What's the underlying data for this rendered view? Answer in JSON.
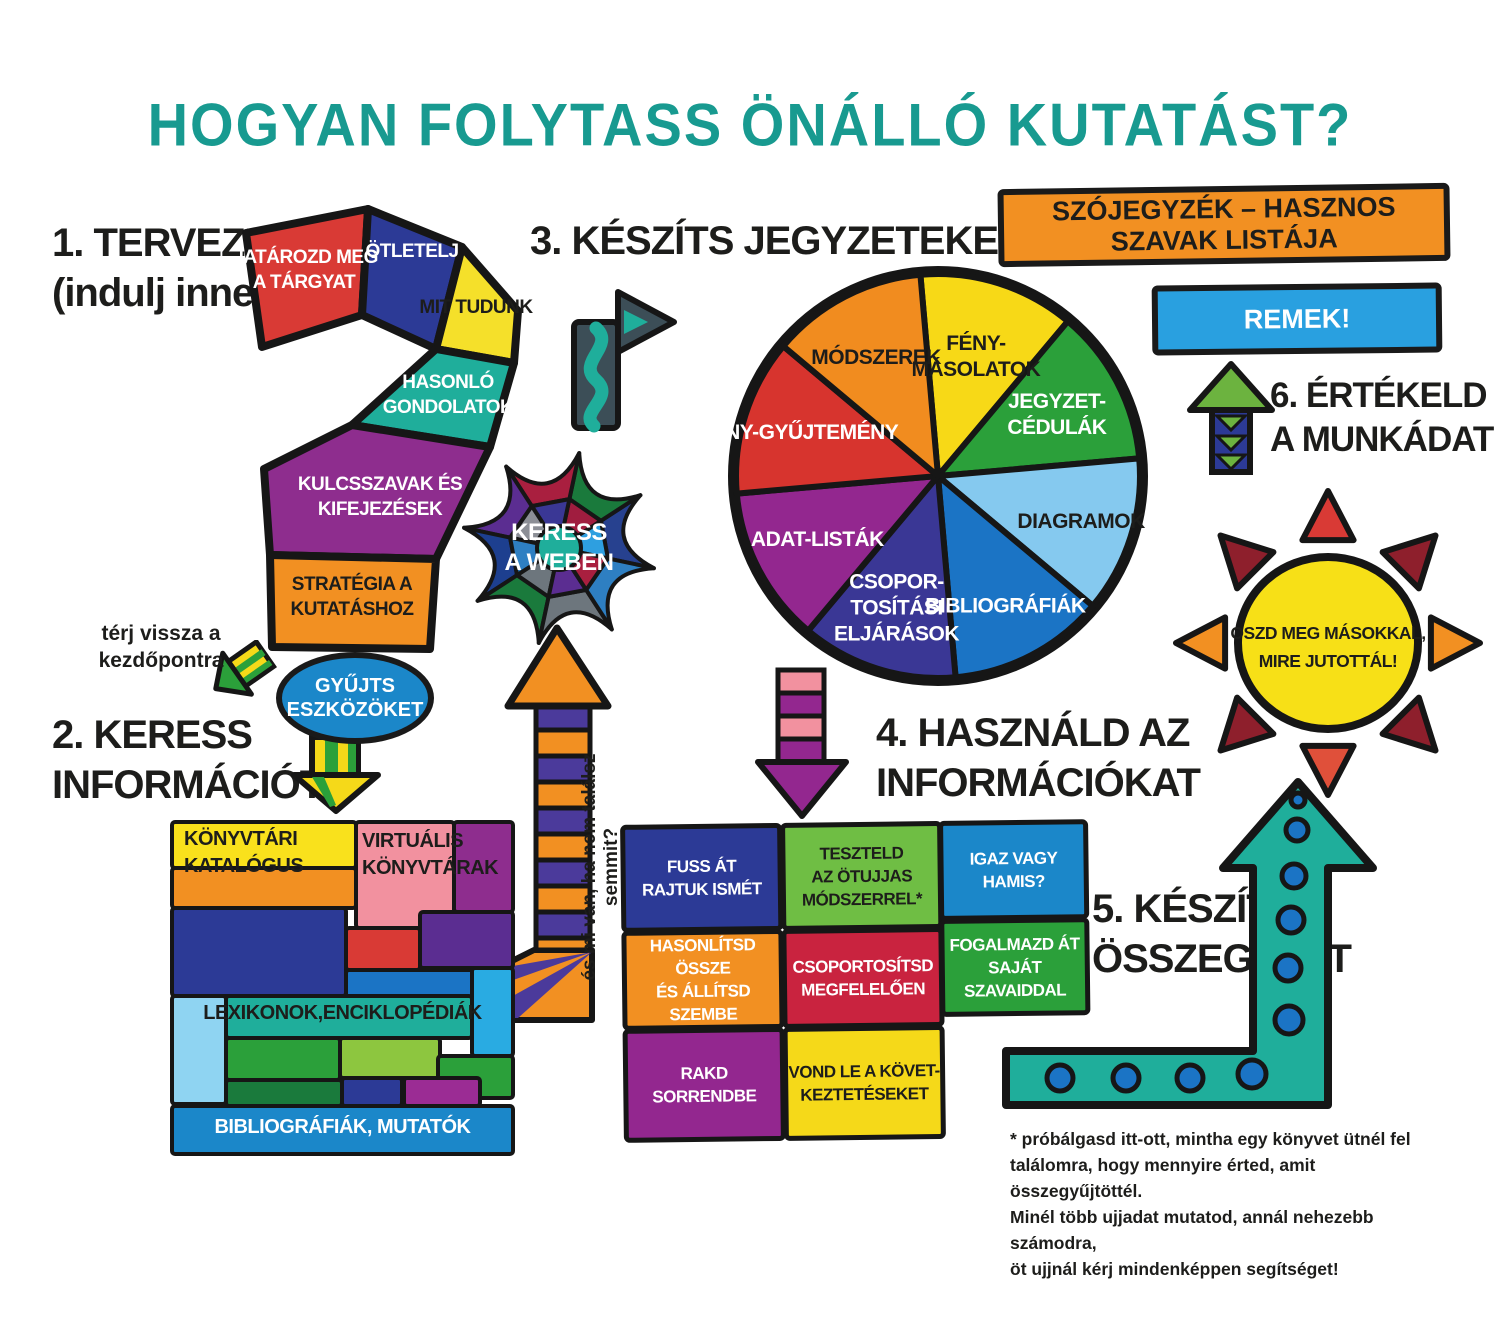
{
  "title": {
    "text": "HOGYAN FOLYTASS ÖNÁLLÓ KUTATÁST?",
    "color": "#189a90"
  },
  "steps": {
    "s1": [
      "1. TERVEZZ",
      "(indulj innen)"
    ],
    "s2": [
      "2. KERESS",
      "INFORMÁCIÓT"
    ],
    "s3": [
      "3. KÉSZÍTS JEGYZETEKET"
    ],
    "s4": [
      "4. HASZNÁLD AZ",
      "INFORMÁCIÓKAT"
    ],
    "s5": [
      "5. KÉSZÍTS",
      "ÖSSZEGZÉST"
    ],
    "s6": [
      "6. ÉRTÉKELD",
      "A MUNKÁDAT"
    ]
  },
  "question_mark": {
    "segments": [
      {
        "label": [
          "HATÁROZD MEG",
          "A TÁRGYAT"
        ],
        "color": "#d93a35",
        "text_color": "#ffffff"
      },
      {
        "label": [
          "ÖTLETELJ"
        ],
        "color": "#2c3a96",
        "text_color": "#ffffff"
      },
      {
        "label": [
          "MIT TUDUNK"
        ],
        "color": "#f5e02a",
        "text_color": "#1d1d1b"
      },
      {
        "label": [
          "HASONLÓ",
          "GONDOLATOK"
        ],
        "color": "#1fae9b",
        "text_color": "#ffffff"
      },
      {
        "label": [
          "KULCSSZAVAK ÉS",
          "KIFEJEZÉSEK"
        ],
        "color": "#8e2d8e",
        "text_color": "#ffffff"
      },
      {
        "label": [
          "STRATÉGIA A",
          "KUTATÁSHOZ"
        ],
        "color": "#f29022",
        "text_color": "#1d1d1b"
      }
    ]
  },
  "pie": {
    "slices": [
      {
        "label": [
          "FÉNY-",
          "MÁSOLATOK"
        ],
        "color": "#f7d917",
        "text_color": "#1d1d1b"
      },
      {
        "label": [
          "JEGYZET-",
          "CÉDULÁK"
        ],
        "color": "#2ba03a",
        "text_color": "#ffffff"
      },
      {
        "label": [
          "DIAGRAMOK"
        ],
        "color": "#85c9ef",
        "text_color": "#1d1d1b"
      },
      {
        "label": [
          "BIBLIOGRÁFIÁK"
        ],
        "color": "#1b74c5",
        "text_color": "#ffffff"
      },
      {
        "label": [
          "CSOPOR-",
          "TOSÍTÁSI",
          "ELJÁRÁSOK"
        ],
        "color": "#3a3795",
        "text_color": "#ffffff"
      },
      {
        "label": [
          "ADAT-LISTÁK"
        ],
        "color": "#93278f",
        "text_color": "#ffffff"
      },
      {
        "label": [
          "TÉNY-GYŰJTEMÉNY"
        ],
        "color": "#d7342e",
        "text_color": "#ffffff"
      },
      {
        "label": [
          "MÓDSZEREK"
        ],
        "color": "#f18c1f",
        "text_color": "#1d1d1b"
      }
    ]
  },
  "web": {
    "label": [
      "KERESS",
      "A WEBEN"
    ],
    "text_color": "#ffffff",
    "core_color": "#1fae9b",
    "outer_colors": [
      "#27418f",
      "#1a7a3c",
      "#a91f3f",
      "#5b2d91",
      "#1d3f8f",
      "#1a7a3c",
      "#6d767d",
      "#2e7fc2"
    ],
    "inner_colors": [
      "#2e9fe0",
      "#a01d3f",
      "#3a3795",
      "#8c8f96",
      "#2e7fc2",
      "#6d767d",
      "#5b2d91",
      "#a91f3f"
    ]
  },
  "banners": {
    "glossary": {
      "text": "SZÓJEGYZÉK – HASZNOS SZAVAK LISTÁJA",
      "color": "#f29022"
    },
    "great": {
      "text": "REMEK!",
      "color": "#29a0e0"
    }
  },
  "sun": {
    "label": [
      "OSZD MEG MÁSOKKAL,",
      "MIRE JUTOTTÁL!"
    ],
    "disc_color": "#f7e017",
    "text_color": "#1d1d1b",
    "ray_colors": [
      "#d93a35",
      "#8e1f2c",
      "#f29022",
      "#8e1f2c",
      "#e0503a",
      "#8e1f2c",
      "#f29022",
      "#8e1f2c"
    ]
  },
  "notes": {
    "return_note": [
      "térj vissza a",
      "kezdőpontra"
    ],
    "collect_tools": [
      "GYŰJTS",
      "ESZKÖZÖKET"
    ],
    "collect_tools_color": "#1b87c9",
    "vertical_note": "és mi van, ha nem találsz semmit?",
    "footnote": [
      "* próbálgasd itt-ott, mintha egy könyvet ütnél fel",
      "találomra, hogy mennyire érted, amit összegyűjtöttél.",
      "Minél több ujjadat mutatod, annál nehezebb számodra,",
      "öt ujjnál kérj mindenképpen segítséget!"
    ]
  },
  "wall": {
    "labels": [
      {
        "text": [
          "KÖNYVTÁRI",
          "KATALÓGUS"
        ],
        "text_color": "#1d1d1b"
      },
      {
        "text": [
          "VIRTUÁLIS",
          "KÖNYVTÁRAK"
        ],
        "text_color": "#1d1d1b"
      },
      {
        "text": [
          "LEXIKONOK,ENCIKLOPÉDIÁK"
        ],
        "text_color": "#1d1d1b"
      },
      {
        "text": [
          "BIBLIOGRÁFIÁK, MUTATÓK"
        ],
        "text_color": "#ffffff"
      }
    ],
    "brick_colors": [
      "#f9e11c",
      "#f29022",
      "#f2919f",
      "#8e2d8e",
      "#2c3a96",
      "#d93a35",
      "#5b2d91",
      "#1b74c5",
      "#29abe2",
      "#8fd4f2",
      "#1fae9b",
      "#2ba03a",
      "#8dc63f",
      "#2ba03a",
      "#1a7a3c",
      "#2c3a96",
      "#9b2c94",
      "#1b87c9"
    ]
  },
  "grid": {
    "cells": [
      {
        "label": [
          "FUSS ÁT",
          "RAJTUK ISMÉT"
        ],
        "color": "#2c3a96",
        "text_color": "#ffffff"
      },
      {
        "label": [
          "TESZTELD",
          "AZ ÖTUJJAS",
          "MÓDSZERREL*"
        ],
        "color": "#6fbe44",
        "text_color": "#1d1d1b"
      },
      {
        "label": [
          "IGAZ VAGY HAMIS?"
        ],
        "color": "#1b87c9",
        "text_color": "#ffffff"
      },
      {
        "label": [
          "HASONLÍTSD ÖSSZE",
          "ÉS ÁLLÍTSD SZEMBE"
        ],
        "color": "#f29022",
        "text_color": "#ffffff"
      },
      {
        "label": [
          "CSOPORTOSÍTSD",
          "MEGFELELŐEN"
        ],
        "color": "#c9233f",
        "text_color": "#ffffff"
      },
      {
        "label": [
          "FOGALMAZD ÁT",
          "SAJÁT SZAVAIDDAL"
        ],
        "color": "#2ba03a",
        "text_color": "#ffffff"
      },
      {
        "label": [
          "RAKD SORRENDBE"
        ],
        "color": "#93278f",
        "text_color": "#ffffff"
      },
      {
        "label": [
          "VOND LE A KÖVET-",
          "KEZTETÉSEKET"
        ],
        "color": "#f5d919",
        "text_color": "#1d1d1b"
      }
    ]
  },
  "arrows": {
    "striped_up": {
      "colors": [
        "#f29022",
        "#4b3a9b"
      ]
    },
    "pink_down": {
      "colors": [
        "#f2919f",
        "#93278f"
      ]
    },
    "yellow_green_down": {
      "colors": [
        "#f5d919",
        "#2ba03a"
      ]
    },
    "return_arrow": {
      "colors": [
        "#f5d919",
        "#2ba03a"
      ]
    },
    "turn_right": {
      "colors": [
        "#3c4e57",
        "#1fae9b"
      ]
    },
    "evaluate_up": {
      "colors": [
        "#6cb33f",
        "#2c3a96"
      ]
    },
    "summary": {
      "body": "#1fae9b",
      "dots": "#1b74c5"
    }
  }
}
